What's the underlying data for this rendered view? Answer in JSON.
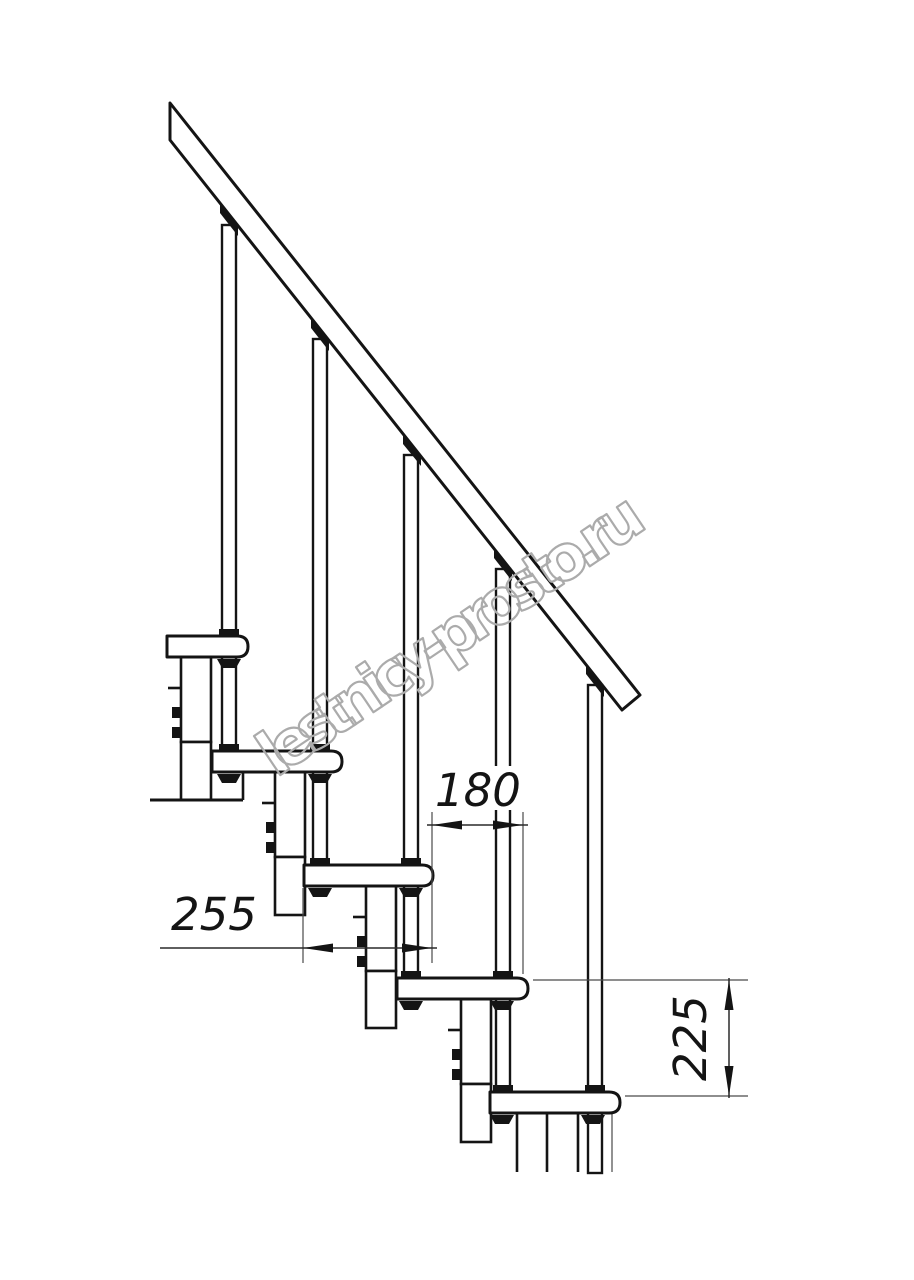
{
  "drawing": {
    "watermark": "lestnicy-prosto.ru",
    "dimensions": {
      "tread_depth": "255",
      "going": "180",
      "rise": "225"
    },
    "colors": {
      "line": "#141414",
      "dim_line": "#2a2a2a",
      "thin_line": "#4a4a4a",
      "watermark": "#ababab",
      "background": "#ffffff"
    }
  }
}
